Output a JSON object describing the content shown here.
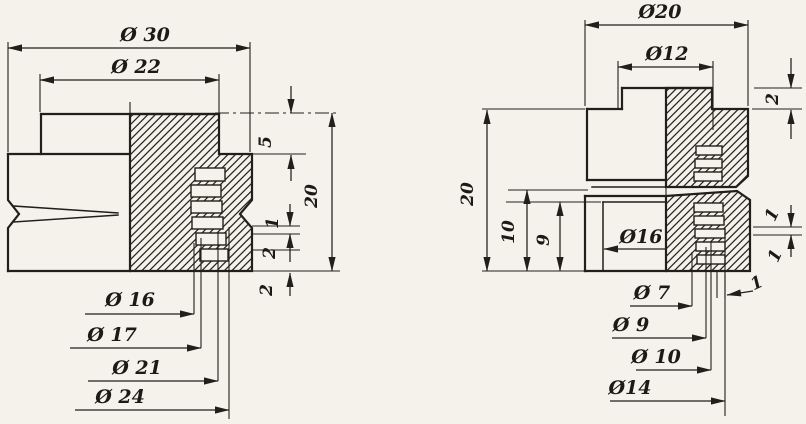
{
  "meta": {
    "kind": "technical drawing, two half-section views of turned parts",
    "paper_color": "#f5f2ec",
    "ink_color": "#221f1a"
  },
  "left_view": {
    "dia_outer": "Ø 30",
    "dia_flange": "Ø 22",
    "flange_height": "5",
    "total_height": "20",
    "step_1": "1",
    "step_2a": "2",
    "step_2b": "2",
    "leader_1": "Ø 16",
    "leader_2": "Ø 17",
    "leader_3": "Ø 21",
    "leader_4": "Ø 24"
  },
  "right_view": {
    "dia_outer": "Ø20",
    "dia_top": "Ø12",
    "lip_height": "2",
    "total_height": "20",
    "height_mid": "10",
    "height_inner": "9",
    "dia_body": "Ø16",
    "tooth_1a": "1",
    "tooth_1b": "1",
    "tooth_1c": "1",
    "leader_1": "Ø 7",
    "leader_2": "Ø 9",
    "leader_3": "Ø 10",
    "leader_4": "Ø14"
  }
}
